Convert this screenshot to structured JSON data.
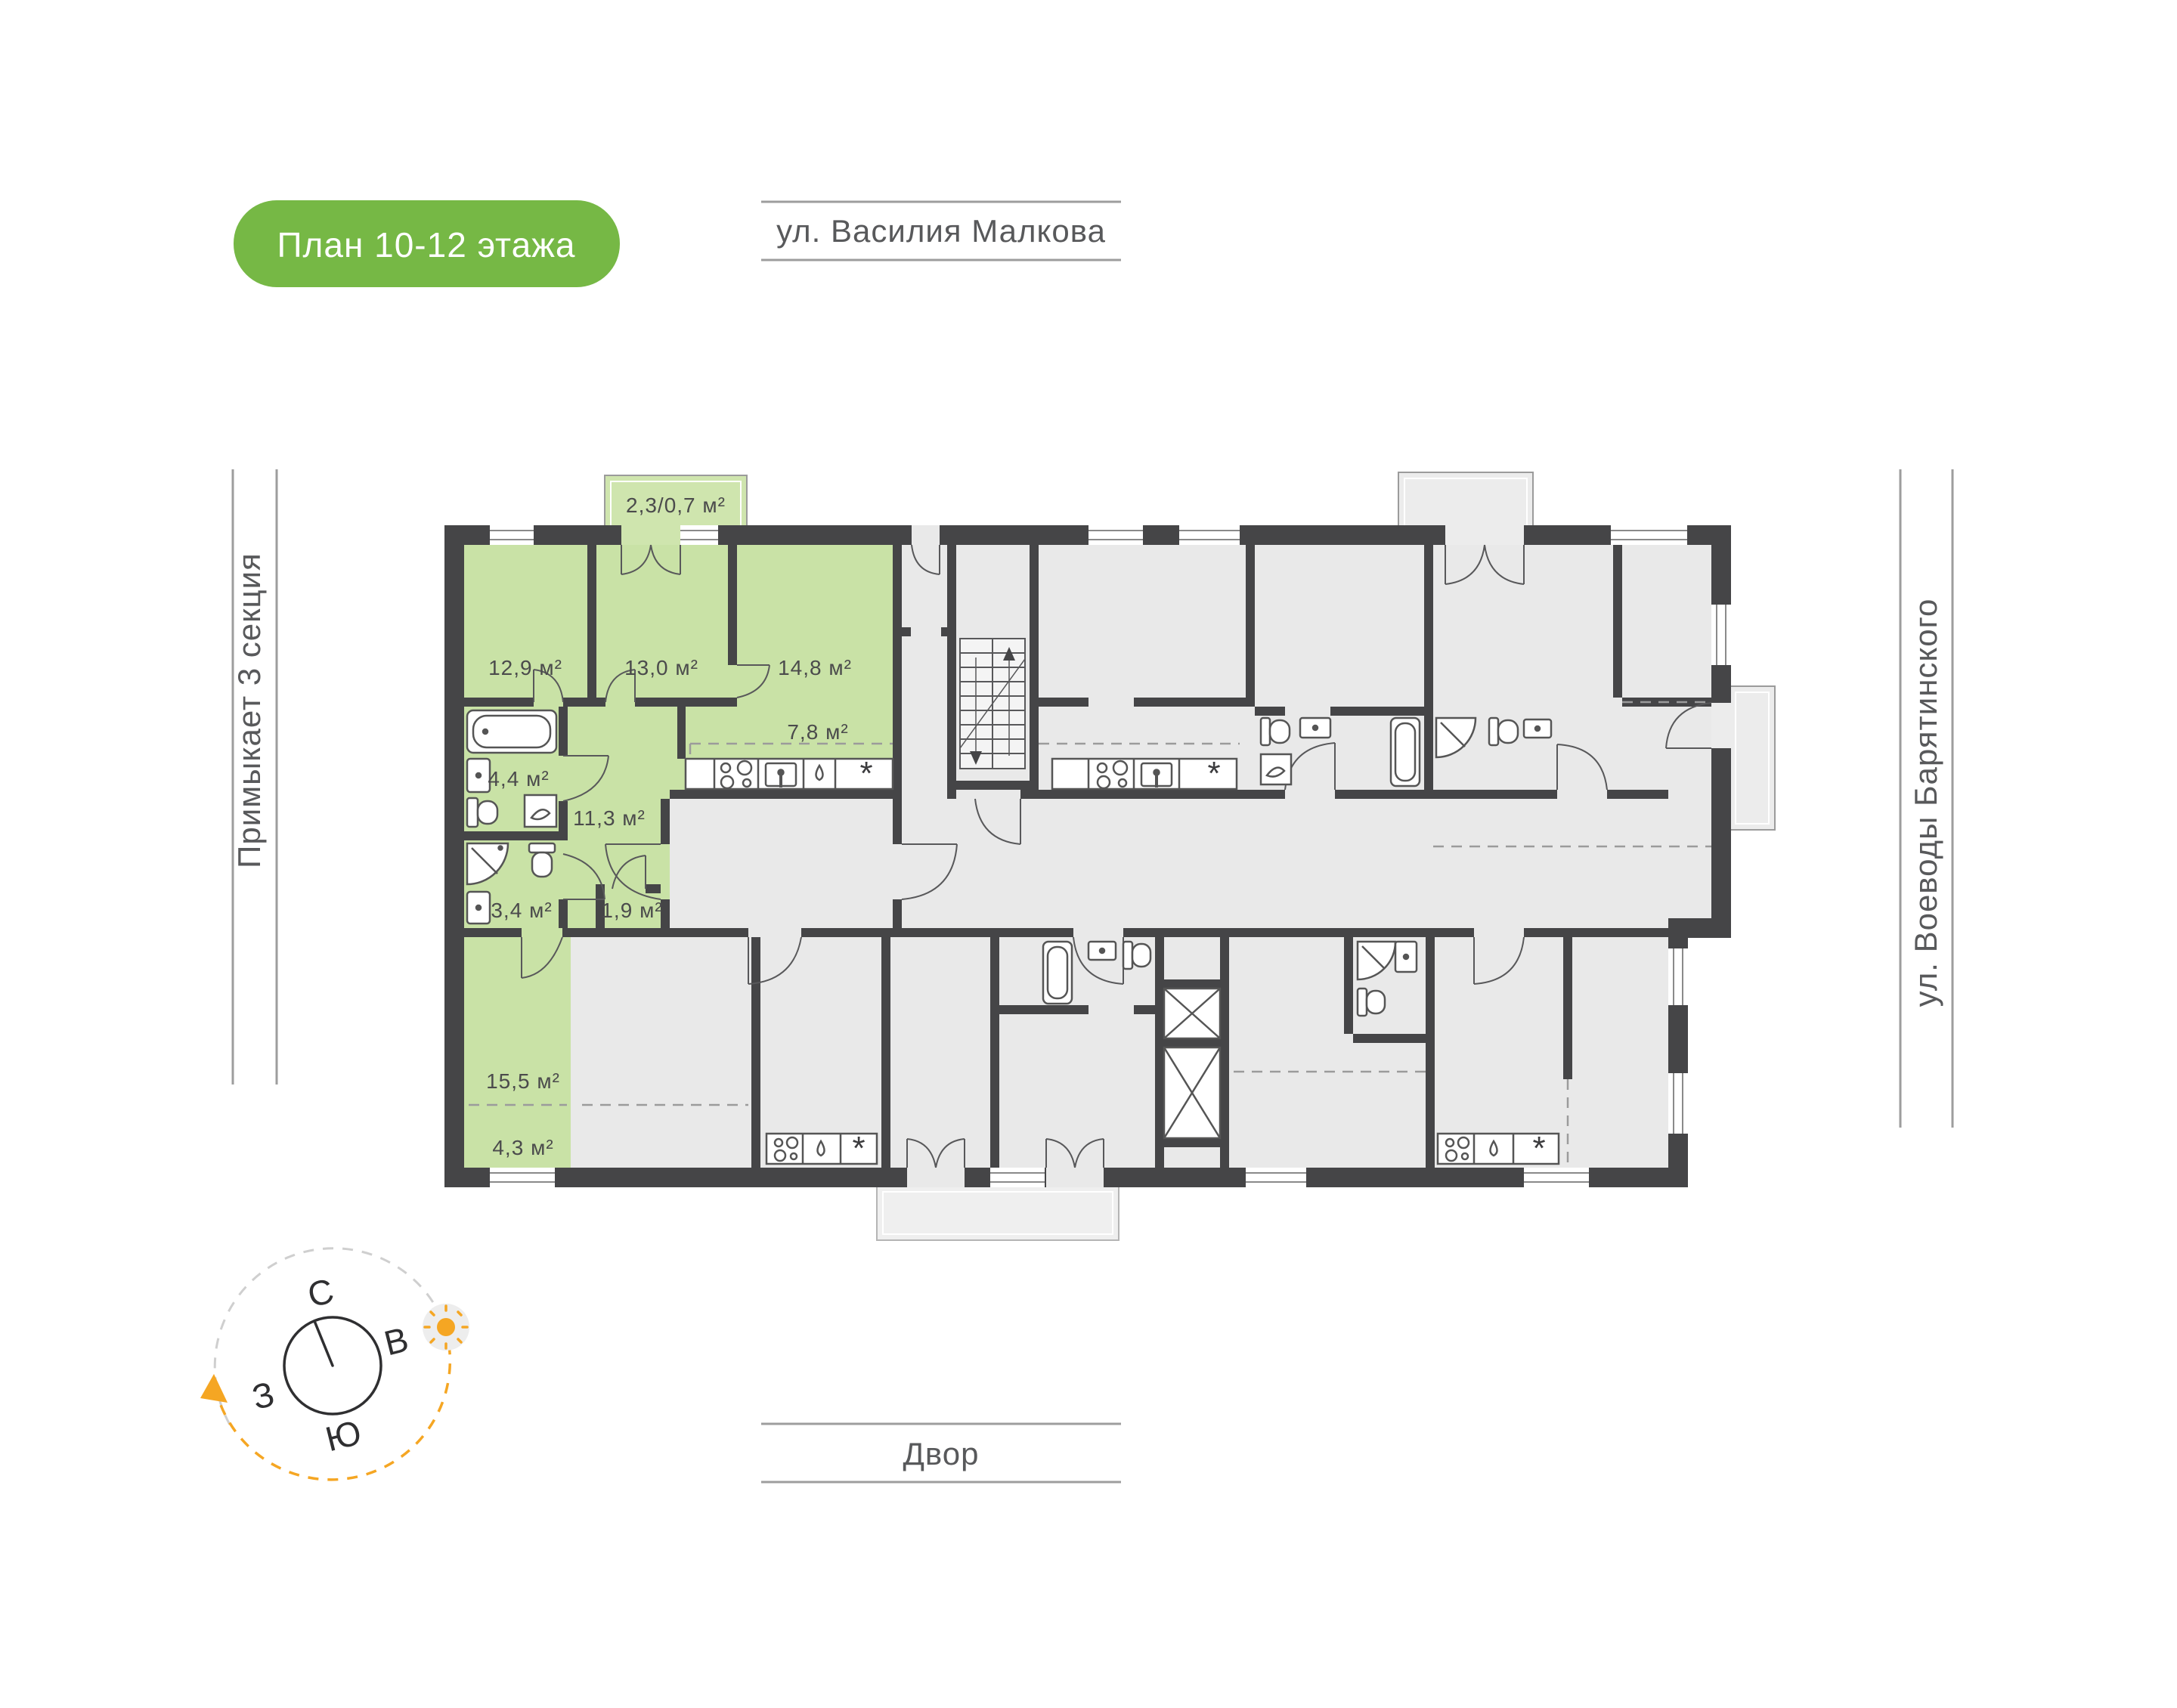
{
  "page": {
    "background": "#ffffff"
  },
  "badge": {
    "label": "План 10-12 этажа",
    "background": "#76b845",
    "text_color": "#ffffff"
  },
  "surroundings": {
    "street_top": "ул. Василия Малкова",
    "street_right": "ул. Воеводы Барятинского",
    "courtyard_bottom": "Двор",
    "adjacent_left": "Примыкает 3 секция"
  },
  "apartment": {
    "highlight_color": "#c9e2a6",
    "rooms": [
      {
        "name": "bedroom-1",
        "area": "12,9 м²"
      },
      {
        "name": "bedroom-2",
        "area": "13,0 м²"
      },
      {
        "name": "bedroom-3",
        "area": "14,8 м²"
      },
      {
        "name": "kitchen-niche",
        "area": "7,8 м²"
      },
      {
        "name": "bathroom",
        "area": "4,4 м²"
      },
      {
        "name": "hallway",
        "area": "11,3 м²"
      },
      {
        "name": "shower-room",
        "area": "3,4 м²"
      },
      {
        "name": "wardrobe",
        "area": "1,9 м²"
      },
      {
        "name": "living-room",
        "area": "15,5 м²"
      },
      {
        "name": "entry-zone",
        "area": "4,3 м²"
      },
      {
        "name": "balcony",
        "area": "2,3/0,7 м²"
      }
    ]
  },
  "compass": {
    "north": "С",
    "east": "В",
    "south": "Ю",
    "west": "З"
  },
  "plan": {
    "wall_color": "#454547",
    "room_color": "#e9e9e9",
    "vent_symbol": "*"
  }
}
